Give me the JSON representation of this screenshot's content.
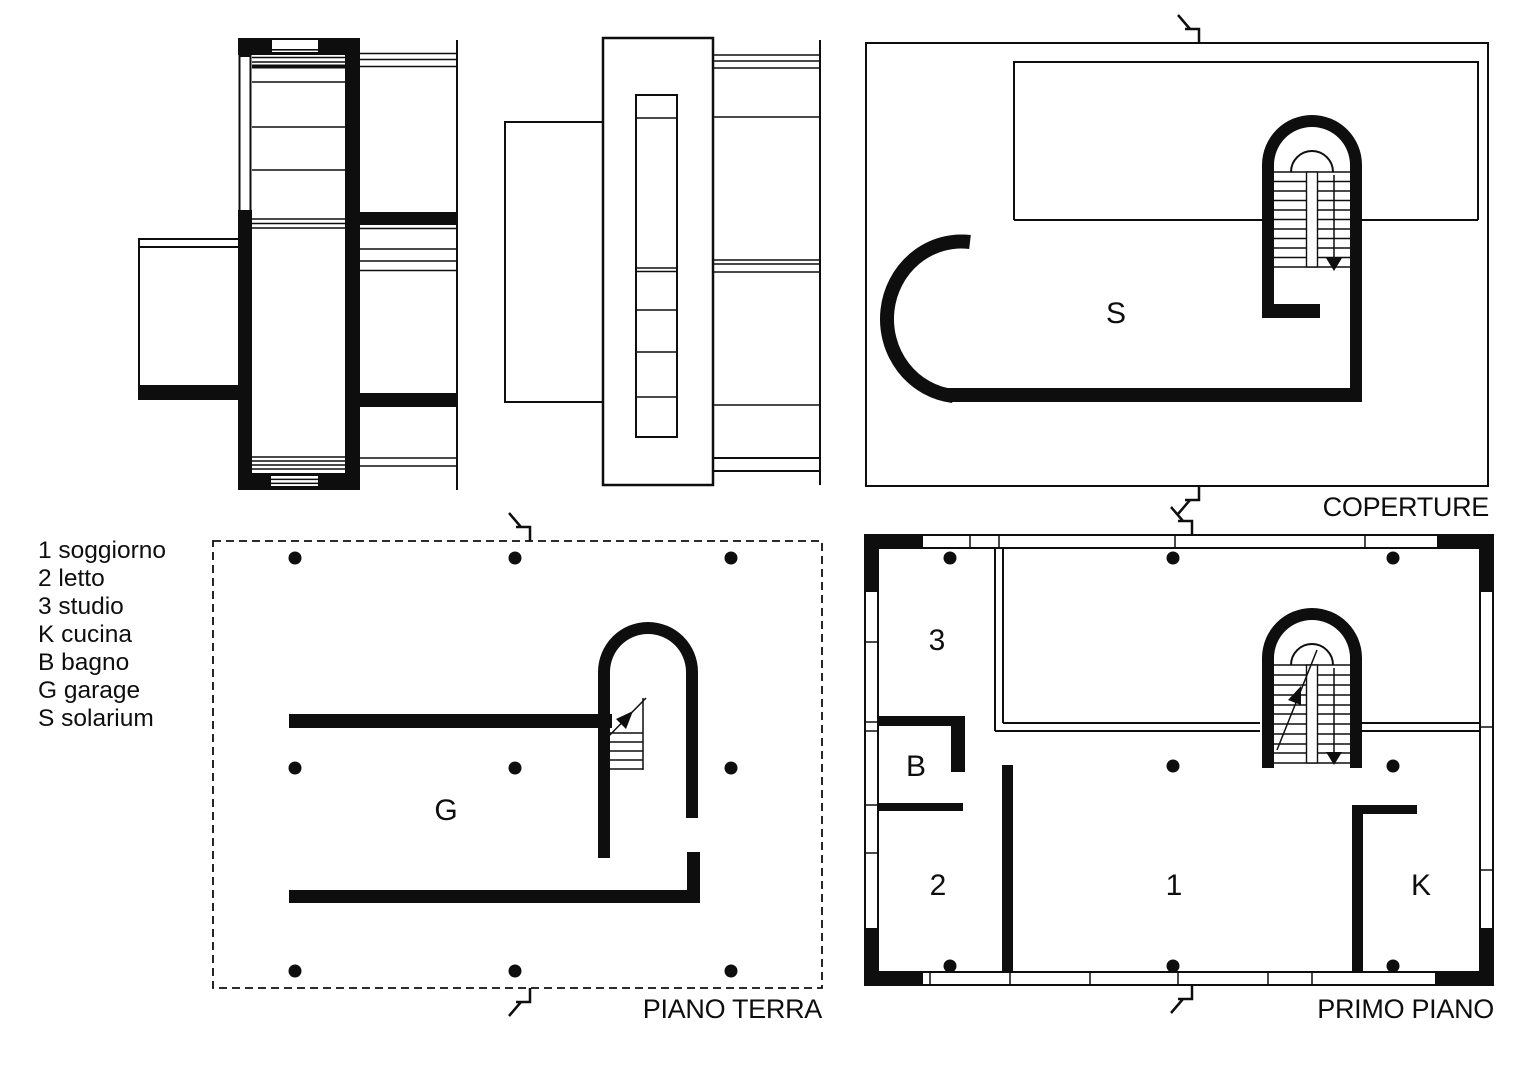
{
  "canvas": {
    "background": "#ffffff",
    "ink": "#0e0e0e"
  },
  "legend": {
    "items": [
      {
        "text": "1 soggiorno"
      },
      {
        "text": "2 letto"
      },
      {
        "text": "3 studio"
      },
      {
        "text": "K cucina"
      },
      {
        "text": "B bagno"
      },
      {
        "text": "G garage"
      },
      {
        "text": "S solarium"
      }
    ]
  },
  "plans": {
    "coperture": {
      "title": "COPERTURE",
      "room_label": "S"
    },
    "piano_terra": {
      "title": "PIANO TERRA",
      "room_label": "G"
    },
    "primo_piano": {
      "title": "PRIMO PIANO",
      "room_labels": {
        "studio": "3",
        "bagno": "B",
        "letto": "2",
        "soggiorno": "1",
        "cucina": "K"
      }
    }
  }
}
